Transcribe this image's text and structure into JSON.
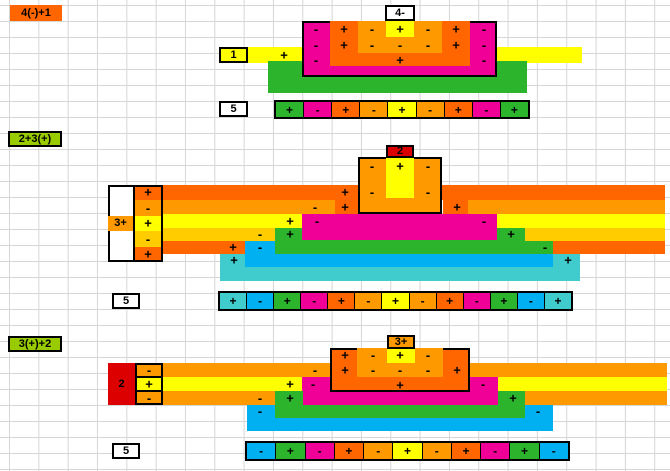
{
  "colors": {
    "O": "#ff6600",
    "L": "#ff9900",
    "A": "#ffcc00",
    "Y": "#ffff00",
    "M": "#f00096",
    "G": "#2db42d",
    "B": "#00b0f0",
    "T": "#40cccc",
    "R": "#dd0000",
    "V": "#99cc00",
    "W": "#ffffff",
    "K": "#000000"
  },
  "sections": [
    {
      "name": "four-minus-plus-one",
      "shapes": [
        {
          "x": 248,
          "y": 47,
          "w": 334,
          "h": 16,
          "c": "Y"
        },
        {
          "x": 268,
          "y": 61,
          "w": 259,
          "h": 32,
          "c": "G"
        },
        {
          "x": 302,
          "y": 21,
          "w": 195,
          "h": 56,
          "c": "M",
          "b": 1
        },
        {
          "x": 330,
          "y": 21,
          "w": 140,
          "h": 45,
          "c": "O"
        },
        {
          "x": 358,
          "y": 21,
          "w": 84,
          "h": 32,
          "c": "L"
        },
        {
          "x": 386,
          "y": 21,
          "w": 28,
          "h": 16,
          "c": "Y"
        }
      ],
      "cells": [
        {
          "n": "expr-label",
          "x": 10,
          "y": 5,
          "w": 52,
          "h": 16,
          "c": "O",
          "t": "4(-)+1"
        },
        {
          "n": "value-box",
          "x": 385,
          "y": 5,
          "w": 30,
          "h": 16,
          "c": "W",
          "t": "4-",
          "b": 1
        },
        {
          "n": "value-box",
          "x": 219,
          "y": 47,
          "w": 29,
          "h": 16,
          "c": "Y",
          "t": "1",
          "b": 1
        },
        {
          "n": "result-box",
          "x": 219,
          "y": 101,
          "w": 29,
          "h": 16,
          "c": "W",
          "t": "5",
          "b": 1
        }
      ],
      "signs": [
        [
          284,
          55,
          "+"
        ],
        [
          316,
          29,
          "-"
        ],
        [
          344,
          29,
          "+"
        ],
        [
          372,
          29,
          "-"
        ],
        [
          400,
          29,
          "+"
        ],
        [
          428,
          29,
          "-"
        ],
        [
          456,
          29,
          "+"
        ],
        [
          484,
          29,
          "-"
        ],
        [
          316,
          45,
          "-"
        ],
        [
          344,
          45,
          "+"
        ],
        [
          372,
          45,
          "-"
        ],
        [
          400,
          45,
          "-"
        ],
        [
          428,
          45,
          "-"
        ],
        [
          456,
          45,
          "+"
        ],
        [
          484,
          45,
          "-"
        ],
        [
          316,
          60,
          "-"
        ],
        [
          400,
          60,
          "+"
        ],
        [
          484,
          60,
          "-"
        ]
      ],
      "bar": {
        "x": 274,
        "y": 100,
        "w": 256,
        "h": 19,
        "cells": [
          {
            "c": "G",
            "s": "+"
          },
          {
            "c": "M",
            "s": "-"
          },
          {
            "c": "O",
            "s": "+"
          },
          {
            "c": "L",
            "s": "-"
          },
          {
            "c": "Y",
            "s": "+"
          },
          {
            "c": "L",
            "s": "-"
          },
          {
            "c": "O",
            "s": "+"
          },
          {
            "c": "M",
            "s": "-"
          },
          {
            "c": "G",
            "s": "+"
          }
        ]
      }
    },
    {
      "name": "two-plus-three-plus",
      "shapes": [
        {
          "x": 220,
          "y": 254,
          "w": 360,
          "h": 27,
          "c": "T"
        },
        {
          "x": 245,
          "y": 241,
          "w": 308,
          "h": 26,
          "c": "B"
        },
        {
          "x": 275,
          "y": 228,
          "w": 278,
          "h": 26,
          "c": "G"
        },
        {
          "x": 302,
          "y": 214,
          "w": 195,
          "h": 26,
          "c": "M"
        },
        {
          "x": 133,
          "y": 228,
          "w": 142,
          "h": 13,
          "c": "A"
        },
        {
          "x": 525,
          "y": 228,
          "w": 140,
          "h": 13,
          "c": "A"
        },
        {
          "x": 133,
          "y": 214,
          "w": 169,
          "h": 14,
          "c": "Y"
        },
        {
          "x": 497,
          "y": 214,
          "w": 168,
          "h": 14,
          "c": "Y"
        },
        {
          "x": 133,
          "y": 200,
          "w": 202,
          "h": 14,
          "c": "L"
        },
        {
          "x": 468,
          "y": 200,
          "w": 197,
          "h": 14,
          "c": "L"
        },
        {
          "x": 133,
          "y": 185,
          "w": 532,
          "h": 15,
          "c": "O"
        },
        {
          "x": 335,
          "y": 185,
          "w": 23,
          "h": 29,
          "c": "O"
        },
        {
          "x": 443,
          "y": 185,
          "w": 25,
          "h": 29,
          "c": "O"
        },
        {
          "x": 133,
          "y": 241,
          "w": 112,
          "h": 13,
          "c": "O"
        },
        {
          "x": 553,
          "y": 241,
          "w": 112,
          "h": 13,
          "c": "O"
        },
        {
          "x": 358,
          "y": 157,
          "w": 84,
          "h": 57,
          "c": "L",
          "b": 1
        },
        {
          "x": 386,
          "y": 157,
          "w": 28,
          "h": 41,
          "c": "Y"
        },
        {
          "x": 108,
          "y": 185,
          "w": 25,
          "h": 77,
          "c": "W"
        },
        {
          "x": 133,
          "y": 185,
          "w": 30,
          "h": 15,
          "c": "O"
        },
        {
          "x": 133,
          "y": 200,
          "w": 30,
          "h": 16,
          "c": "L"
        },
        {
          "x": 133,
          "y": 216,
          "w": 30,
          "h": 15,
          "c": "Y"
        },
        {
          "x": 133,
          "y": 231,
          "w": 30,
          "h": 16,
          "c": "A"
        },
        {
          "x": 133,
          "y": 247,
          "w": 30,
          "h": 15,
          "c": "O"
        },
        {
          "x": 133,
          "y": 185,
          "w": 2,
          "h": 77,
          "c": "K"
        }
      ],
      "frames": [
        {
          "x": 108,
          "y": 185,
          "w": 55,
          "h": 77
        }
      ],
      "cells": [
        {
          "n": "expr-label",
          "x": 8,
          "y": 131,
          "w": 54,
          "h": 16,
          "c": "V",
          "t": "2+3(+)",
          "b": 1
        },
        {
          "n": "value-box",
          "x": 386,
          "y": 145,
          "w": 28,
          "h": 13,
          "c": "R",
          "t": "2",
          "b": 1
        },
        {
          "n": "value-box",
          "x": 108,
          "y": 216,
          "w": 25,
          "h": 15,
          "c": "L",
          "t": "3+"
        },
        {
          "n": "result-box",
          "x": 112,
          "y": 293,
          "w": 28,
          "h": 16,
          "c": "W",
          "t": "5",
          "b": 1
        }
      ],
      "signs": [
        [
          148,
          192,
          "+"
        ],
        [
          148,
          208,
          "-"
        ],
        [
          148,
          223,
          "+"
        ],
        [
          148,
          239,
          "-"
        ],
        [
          148,
          254,
          "+"
        ],
        [
          345,
          192,
          "+"
        ],
        [
          315,
          207,
          "-"
        ],
        [
          345,
          207,
          "+"
        ],
        [
          457,
          207,
          "+"
        ],
        [
          290,
          221,
          "+"
        ],
        [
          317,
          221,
          "-"
        ],
        [
          484,
          221,
          "-"
        ],
        [
          260,
          234,
          "-"
        ],
        [
          290,
          234,
          "+"
        ],
        [
          511,
          234,
          "+"
        ],
        [
          233,
          247,
          "+"
        ],
        [
          260,
          247,
          "-"
        ],
        [
          545,
          247,
          "-"
        ],
        [
          234,
          260,
          "+"
        ],
        [
          568,
          260,
          "+"
        ],
        [
          372,
          166,
          "-"
        ],
        [
          400,
          166,
          "+"
        ],
        [
          428,
          166,
          "-"
        ],
        [
          372,
          192,
          "-"
        ],
        [
          428,
          192,
          "-"
        ]
      ],
      "bar": {
        "x": 218,
        "y": 291,
        "w": 355,
        "h": 20,
        "cells": [
          {
            "c": "T",
            "s": "+"
          },
          {
            "c": "B",
            "s": "-"
          },
          {
            "c": "G",
            "s": "+"
          },
          {
            "c": "M",
            "s": "-"
          },
          {
            "c": "O",
            "s": "+"
          },
          {
            "c": "L",
            "s": "-"
          },
          {
            "c": "Y",
            "s": "+"
          },
          {
            "c": "L",
            "s": "-"
          },
          {
            "c": "O",
            "s": "+"
          },
          {
            "c": "M",
            "s": "-"
          },
          {
            "c": "G",
            "s": "+"
          },
          {
            "c": "B",
            "s": "-"
          },
          {
            "c": "T",
            "s": "+"
          }
        ]
      }
    },
    {
      "name": "three-plus-plus-two",
      "shapes": [
        {
          "x": 247,
          "y": 405,
          "w": 306,
          "h": 26,
          "c": "B"
        },
        {
          "x": 275,
          "y": 391,
          "w": 250,
          "h": 27,
          "c": "G"
        },
        {
          "x": 303,
          "y": 391,
          "w": 195,
          "h": 14,
          "c": "M"
        },
        {
          "x": 302,
          "y": 377,
          "w": 28,
          "h": 14,
          "c": "M"
        },
        {
          "x": 470,
          "y": 377,
          "w": 28,
          "h": 14,
          "c": "M"
        },
        {
          "x": 163,
          "y": 391,
          "w": 112,
          "h": 14,
          "c": "L"
        },
        {
          "x": 525,
          "y": 391,
          "w": 142,
          "h": 14,
          "c": "L"
        },
        {
          "x": 163,
          "y": 377,
          "w": 139,
          "h": 14,
          "c": "Y"
        },
        {
          "x": 498,
          "y": 377,
          "w": 169,
          "h": 14,
          "c": "Y"
        },
        {
          "x": 163,
          "y": 363,
          "w": 167,
          "h": 14,
          "c": "L"
        },
        {
          "x": 470,
          "y": 363,
          "w": 197,
          "h": 14,
          "c": "L"
        },
        {
          "x": 330,
          "y": 348,
          "w": 140,
          "h": 44,
          "c": "O",
          "b": 1
        },
        {
          "x": 357,
          "y": 348,
          "w": 86,
          "h": 29,
          "c": "L"
        },
        {
          "x": 387,
          "y": 348,
          "w": 28,
          "h": 15,
          "c": "Y"
        },
        {
          "x": 135,
          "y": 363,
          "w": 28,
          "h": 14,
          "c": "L"
        },
        {
          "x": 135,
          "y": 377,
          "w": 28,
          "h": 14,
          "c": "Y"
        },
        {
          "x": 135,
          "y": 391,
          "w": 28,
          "h": 14,
          "c": "L"
        },
        {
          "x": 135,
          "y": 363,
          "w": 2,
          "h": 42,
          "c": "K"
        },
        {
          "x": 137,
          "y": 376,
          "w": 26,
          "h": 2,
          "c": "K"
        },
        {
          "x": 137,
          "y": 390,
          "w": 26,
          "h": 2,
          "c": "K"
        }
      ],
      "frames": [
        {
          "x": 108,
          "y": 363,
          "w": 55,
          "h": 42
        }
      ],
      "cells": [
        {
          "n": "expr-label",
          "x": 8,
          "y": 336,
          "w": 54,
          "h": 16,
          "c": "V",
          "t": "3(+)+2",
          "b": 1
        },
        {
          "n": "value-box",
          "x": 387,
          "y": 335,
          "w": 28,
          "h": 14,
          "c": "L",
          "t": "3+",
          "b": 1
        },
        {
          "n": "value-box",
          "x": 108,
          "y": 363,
          "w": 27,
          "h": 42,
          "c": "R",
          "t": "2"
        },
        {
          "n": "result-box",
          "x": 112,
          "y": 443,
          "w": 28,
          "h": 16,
          "c": "W",
          "t": "5",
          "b": 1
        }
      ],
      "signs": [
        [
          149,
          370,
          "-"
        ],
        [
          149,
          384,
          "+"
        ],
        [
          149,
          398,
          "-"
        ],
        [
          315,
          370,
          "-"
        ],
        [
          290,
          384,
          "+"
        ],
        [
          313,
          384,
          "-"
        ],
        [
          483,
          384,
          "-"
        ],
        [
          260,
          398,
          "-"
        ],
        [
          290,
          398,
          "+"
        ],
        [
          513,
          398,
          "+"
        ],
        [
          260,
          411,
          "-"
        ],
        [
          538,
          411,
          "-"
        ],
        [
          345,
          355,
          "+"
        ],
        [
          373,
          355,
          "-"
        ],
        [
          400,
          355,
          "+"
        ],
        [
          428,
          355,
          "-"
        ],
        [
          345,
          370,
          "+"
        ],
        [
          373,
          370,
          "-"
        ],
        [
          400,
          370,
          "-"
        ],
        [
          428,
          370,
          "-"
        ],
        [
          457,
          370,
          "+"
        ],
        [
          400,
          385,
          "+"
        ]
      ],
      "bar": {
        "x": 245,
        "y": 441,
        "w": 325,
        "h": 20,
        "cells": [
          {
            "c": "B",
            "s": "-"
          },
          {
            "c": "G",
            "s": "+"
          },
          {
            "c": "M",
            "s": "-"
          },
          {
            "c": "O",
            "s": "+"
          },
          {
            "c": "L",
            "s": "-"
          },
          {
            "c": "Y",
            "s": "+"
          },
          {
            "c": "L",
            "s": "-"
          },
          {
            "c": "O",
            "s": "+"
          },
          {
            "c": "M",
            "s": "-"
          },
          {
            "c": "G",
            "s": "+"
          },
          {
            "c": "B",
            "s": "-"
          }
        ]
      }
    }
  ]
}
